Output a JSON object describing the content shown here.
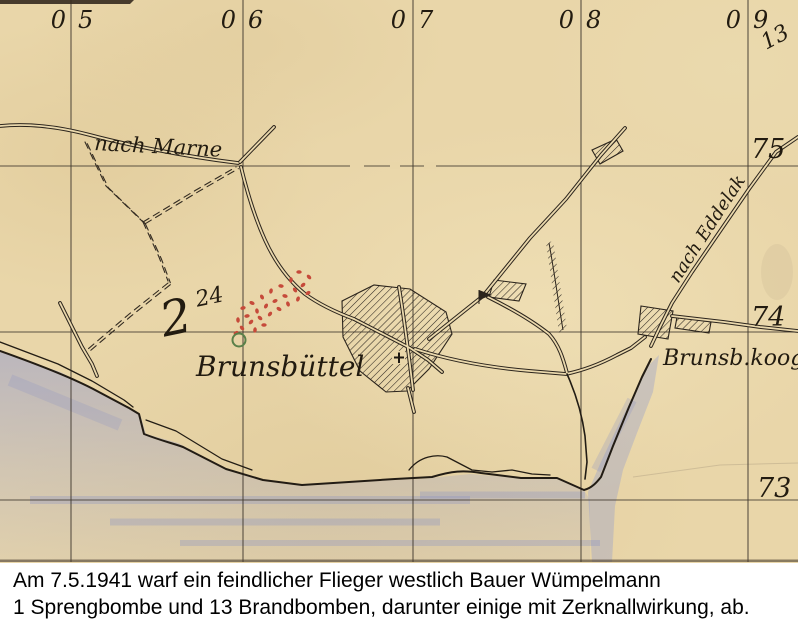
{
  "map": {
    "grid_columns": [
      {
        "prefix": "0",
        "digit": "5"
      },
      {
        "prefix": "0",
        "digit": "6"
      },
      {
        "prefix": "0",
        "digit": "7"
      },
      {
        "prefix": "0",
        "digit": "8"
      },
      {
        "prefix": "0",
        "digit": "9"
      }
    ],
    "grid_rows": [
      "75",
      "74",
      "73"
    ],
    "corner_number": "13",
    "place_labels": {
      "nach_marne": "nach Marne",
      "brunsbuettel": "Brunsbüttel",
      "brunsb_koog": "Brunsb.koog",
      "nach_eddelak": "nach Eddelak"
    },
    "annotations": {
      "green_figure": "2",
      "green_figure_sup": "24"
    },
    "colors": {
      "paper": "#e9d6a9",
      "ink": "#2b241c",
      "bomb_dots": "#c64a3a",
      "green_mark": "#5a8049",
      "water": "#969dcd",
      "corner_number": "#b0714a"
    },
    "impact_dots": [
      [
        299,
        272
      ],
      [
        309,
        277
      ],
      [
        291,
        280
      ],
      [
        303,
        285
      ],
      [
        281,
        286
      ],
      [
        295,
        290
      ],
      [
        271,
        291
      ],
      [
        308,
        293
      ],
      [
        285,
        296
      ],
      [
        262,
        297
      ],
      [
        298,
        299
      ],
      [
        275,
        301
      ],
      [
        252,
        303
      ],
      [
        288,
        304
      ],
      [
        266,
        306
      ],
      [
        243,
        308
      ],
      [
        279,
        309
      ],
      [
        257,
        311
      ],
      [
        270,
        314
      ],
      [
        247,
        316
      ],
      [
        260,
        318
      ],
      [
        238,
        320
      ],
      [
        251,
        322
      ],
      [
        264,
        325
      ],
      [
        242,
        328
      ],
      [
        255,
        330
      ],
      [
        236,
        333
      ]
    ]
  },
  "caption": {
    "line1": "Am 7.5.1941 warf ein feindlicher Flieger westlich Bauer Wümpelmann",
    "line2": "1 Sprengbombe und 13 Brandbomben, darunter einige mit Zerknallwirkung, ab."
  }
}
